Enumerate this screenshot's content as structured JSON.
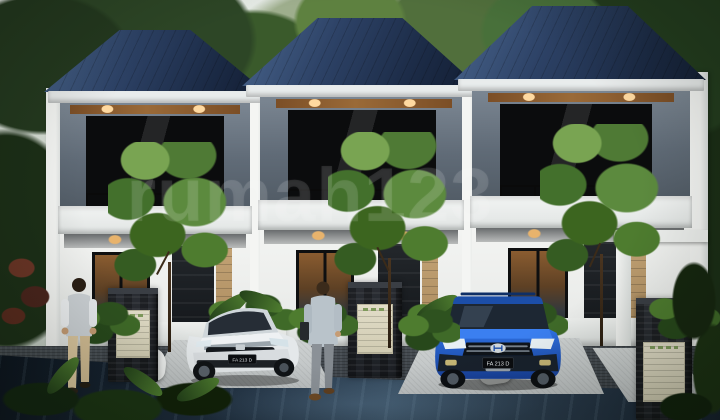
{
  "image": {
    "type": "3d-architectural-render",
    "subject": "Row of three identical modern two-storey townhouses with dark blue hip roofs, glowing windows, front gardens, two parked cars and two people walking in",
    "watermark_text": "rumah123"
  },
  "cars": [
    {
      "label": "white-sedan",
      "badge": "Honda",
      "plate": "FA 213 D",
      "body_color": "#e4e8ea"
    },
    {
      "label": "blue-suv",
      "badge": "Hyundai",
      "plate": "FA 213 D",
      "body_color": "#2b6ade"
    }
  ],
  "palette": {
    "sky": "#e3e9e4",
    "foliage_dark": "#1d3318",
    "foliage_light": "#6f9a48",
    "roof_blue": "#24385c",
    "fascia_white": "#eceeee",
    "upper_wall_grey": "#67727e",
    "window_glow_amber": "#b27e44",
    "ground_wall_white": "#f2f3f1",
    "stone_pillar": "#23262b",
    "sign_beige": "#dcd7c0",
    "driveway_grey": "#c6cac9",
    "road_dark": "#131d2b"
  }
}
